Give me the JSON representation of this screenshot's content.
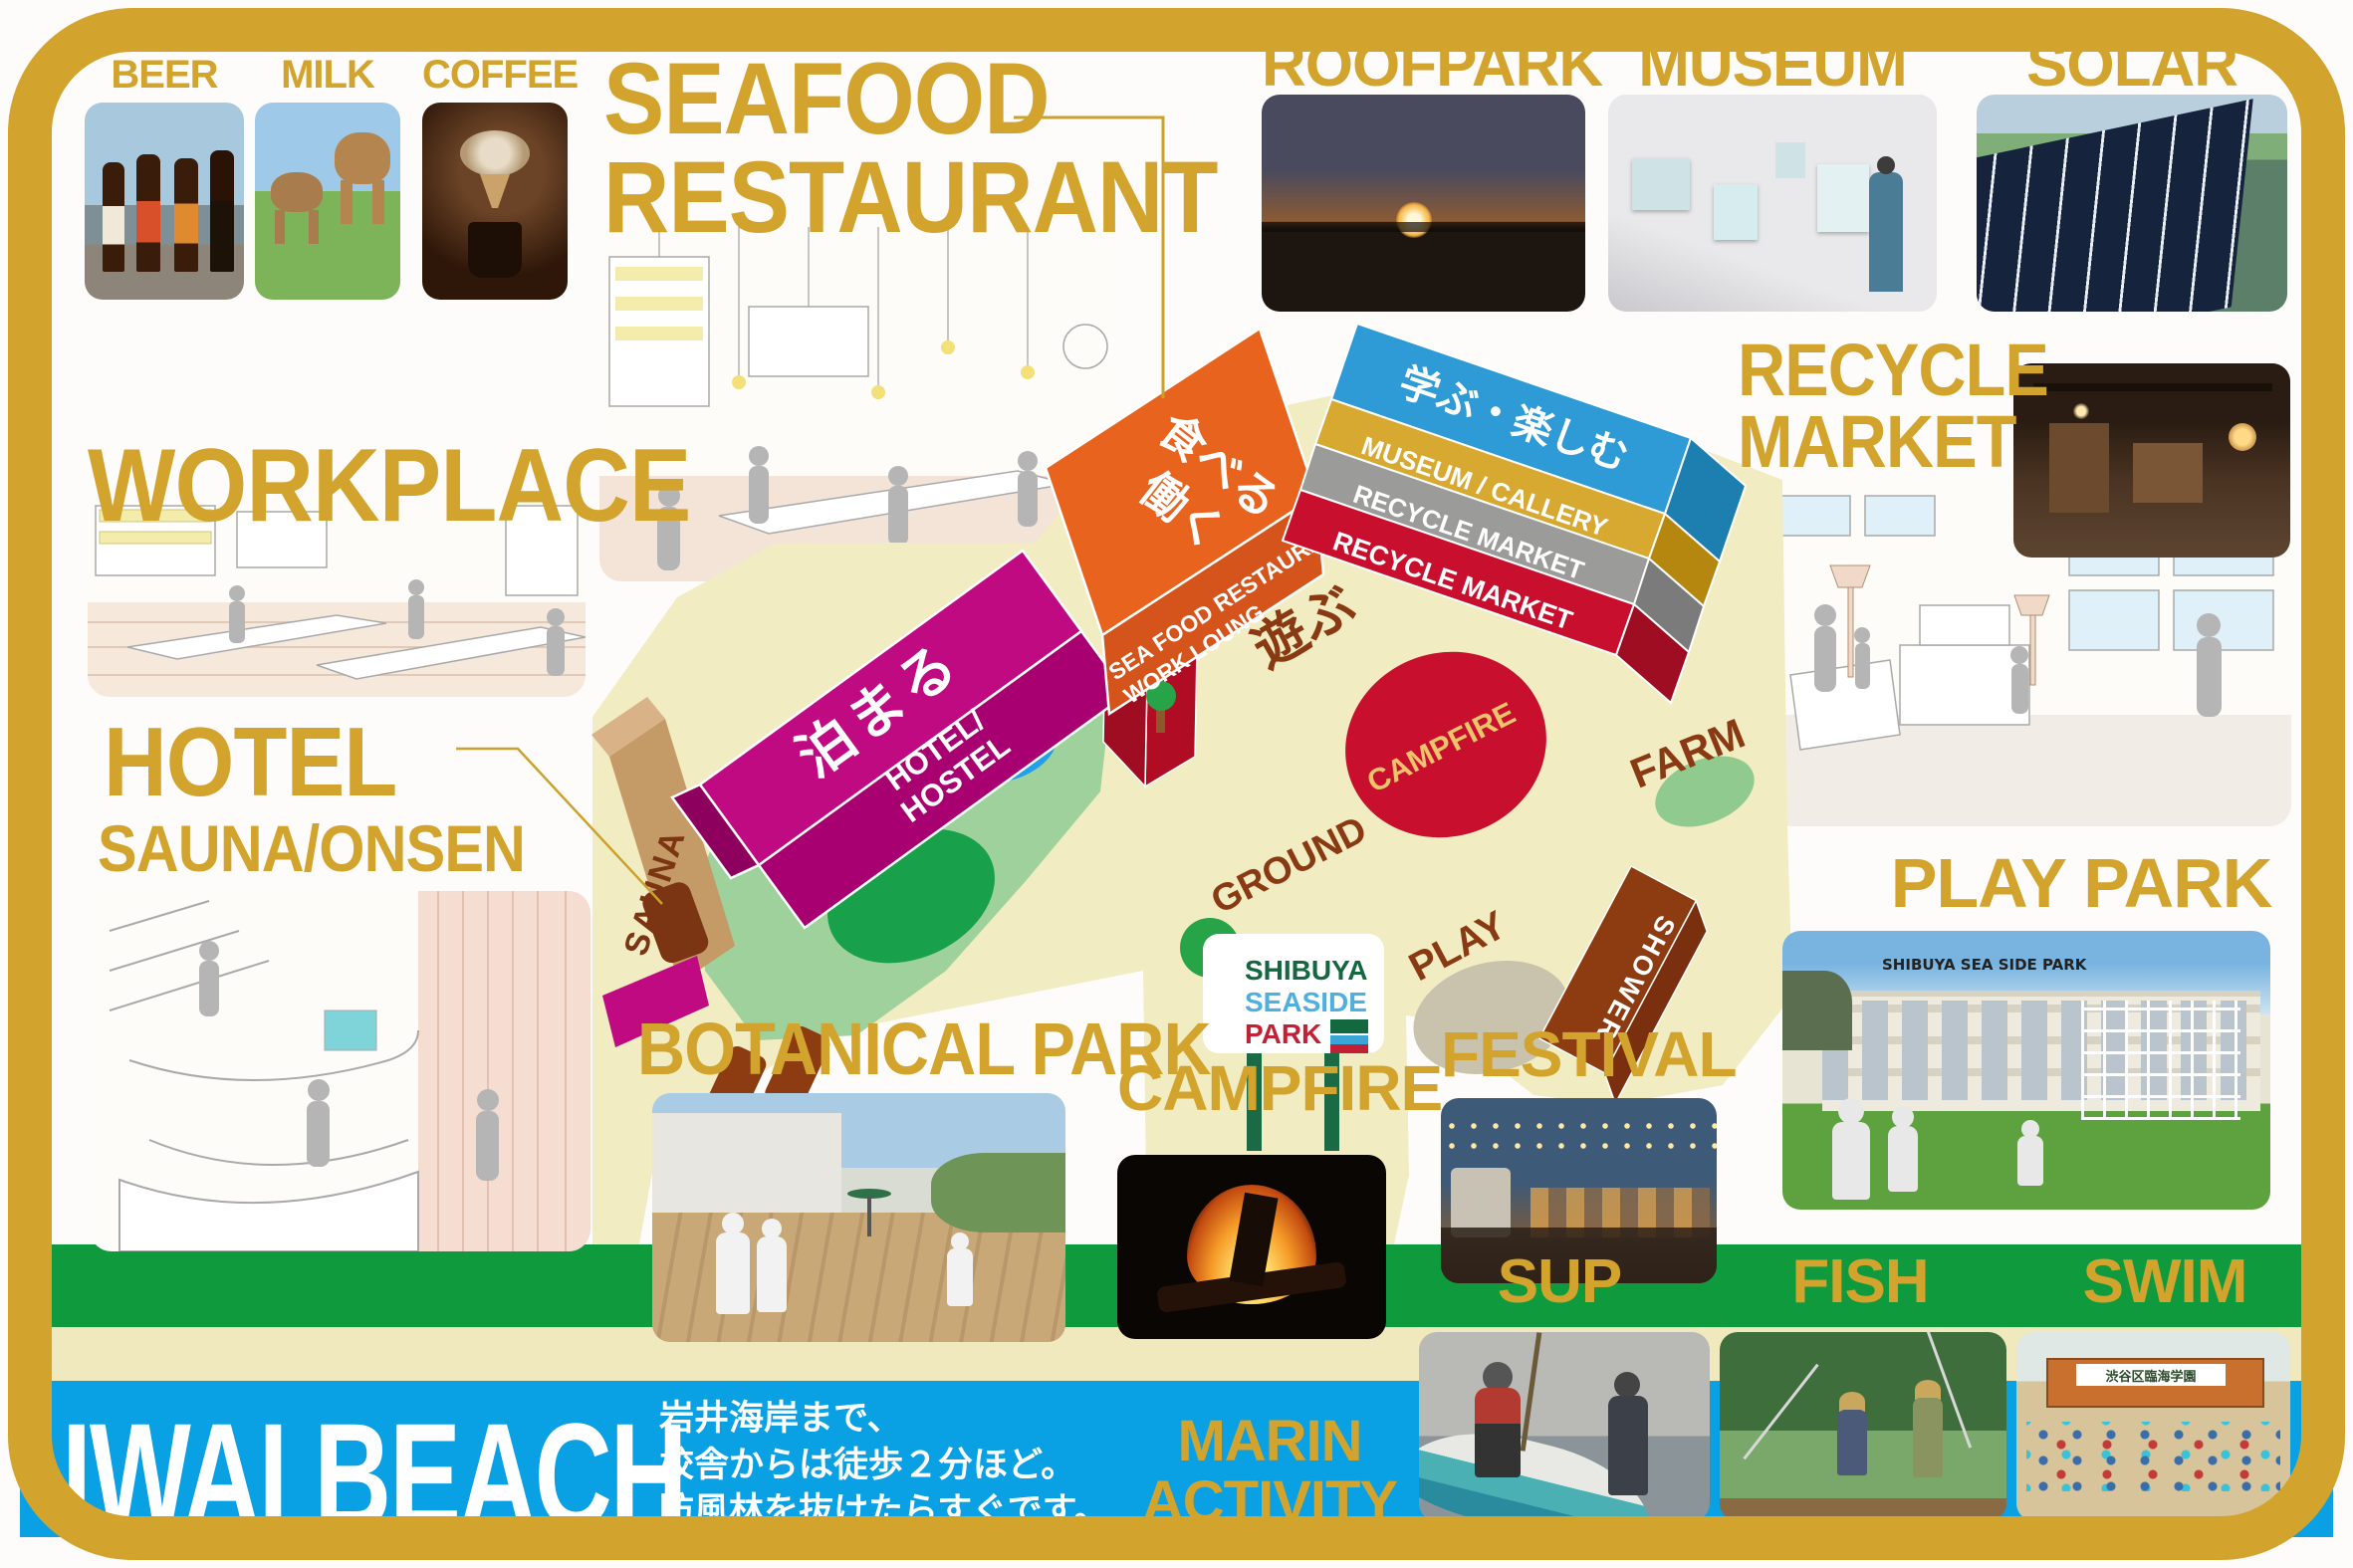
{
  "palette": {
    "gold": "#d2a42e",
    "green_band": "#0f9a3d",
    "blue_band": "#09a0e4",
    "cream_strip": "#efe9bd",
    "map_cream": "#f1ecc2",
    "magenta": "#c00a82",
    "orange": "#e8641e",
    "blue_building": "#2e9bd6",
    "red": "#c8102e",
    "brown_text": "#8a3a12"
  },
  "labels": {
    "beer": "BEER",
    "milk": "MILK",
    "coffee": "COFFEE",
    "workplace": "WORKPLACE",
    "seafood1": "SEAFOOD",
    "seafood2": "RESTAURANT",
    "roofpark": "ROOFPARK",
    "museum": "MUSEUM",
    "solar": "SOLAR",
    "recycle1": "RECYCLE",
    "recycle2": "MARKET",
    "hotel": "HOTEL",
    "hotel_sub": "SAUNA/ONSEN",
    "botanical": "BOTANICAL PARK",
    "campfire": "CAMPFIRE",
    "festival": "FESTIVAL",
    "playpark": "PLAY PARK",
    "sup": "SUP",
    "fish": "FISH",
    "swim": "SWIM",
    "marin1": "MARIN",
    "marin2": "ACTIVITY"
  },
  "map": {
    "stay_jp": "泊まる",
    "stay_en1": "HOTEL/",
    "stay_en2": "HOSTEL",
    "eat_jp1": "食べる",
    "eat_jp2": "働く",
    "eat_en1": "SEA FOOD RESTAURANT",
    "eat_en2": "WORK LOUNG",
    "learn_jp": "学ぶ・楽しむ",
    "learn_layer1": "MUSEUM / CALLERY",
    "learn_layer2": "RECYCLE MARKET",
    "learn_layer3": "RECYCLE MARKET",
    "play_jp": "遊ぶ",
    "sauna": "SAUNA",
    "park": "PARK",
    "campfire_area": "CAMPFIRE",
    "ground": "GROUND",
    "farm": "FARM",
    "play": "PLAY",
    "shower": "SHOWER"
  },
  "sign": {
    "line1": "SHIBUYA",
    "line2": "SEASIDE",
    "line3": "PARK"
  },
  "beach": {
    "title": "IWAI BEACH",
    "desc1": "岩井海岸まで、",
    "desc2": "校舎からは徒歩２分ほど。",
    "desc3": "防風林を抜けたらすぐです。"
  },
  "photo_texts": {
    "playpark_building": "SHIBUYA SEA SIDE PARK",
    "swim_banner": "渋谷区臨海学園"
  }
}
